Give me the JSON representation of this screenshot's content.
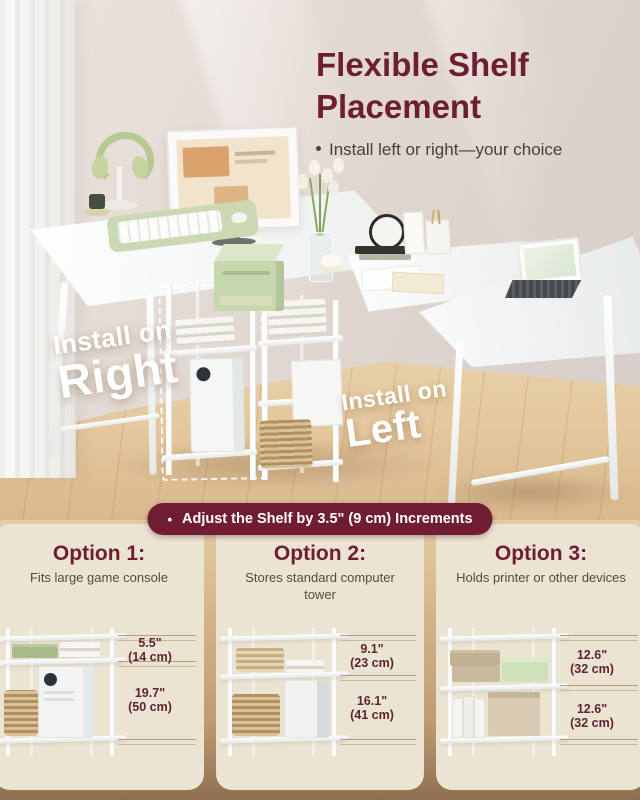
{
  "colors": {
    "accent_maroon": "#6e1e33",
    "banner_bg": "#701d33",
    "card_bg": "#ece4d2",
    "measure_text": "#5e2433",
    "sage_green": "#c7d7ae",
    "wood": "#d3b48a"
  },
  "header": {
    "title": "Flexible Shelf Placement",
    "bullet": "•",
    "subtitle": "Install left or right—your choice"
  },
  "photo_overlays": {
    "right_line1": "Install on",
    "right_line2": "Right",
    "left_line1": "Install on",
    "left_line2": "Left"
  },
  "banner": {
    "bullet": "•",
    "text": "Adjust the Shelf by 3.5\" (9 cm) Increments"
  },
  "options": [
    {
      "title": "Option 1:",
      "desc": "Fits large game console",
      "measurements": [
        {
          "inches": "5.5\"",
          "cm": "(14 cm)"
        },
        {
          "inches": "19.7\"",
          "cm": "(50 cm)"
        }
      ]
    },
    {
      "title": "Option 2:",
      "desc": "Stores standard computer tower",
      "measurements": [
        {
          "inches": "9.1\"",
          "cm": "(23 cm)"
        },
        {
          "inches": "16.1\"",
          "cm": "(41 cm)"
        }
      ]
    },
    {
      "title": "Option 3:",
      "desc": "Holds printer or other devices",
      "measurements": [
        {
          "inches": "12.6\"",
          "cm": "(32 cm)"
        },
        {
          "inches": "12.6\"",
          "cm": "(32 cm)"
        }
      ]
    }
  ]
}
